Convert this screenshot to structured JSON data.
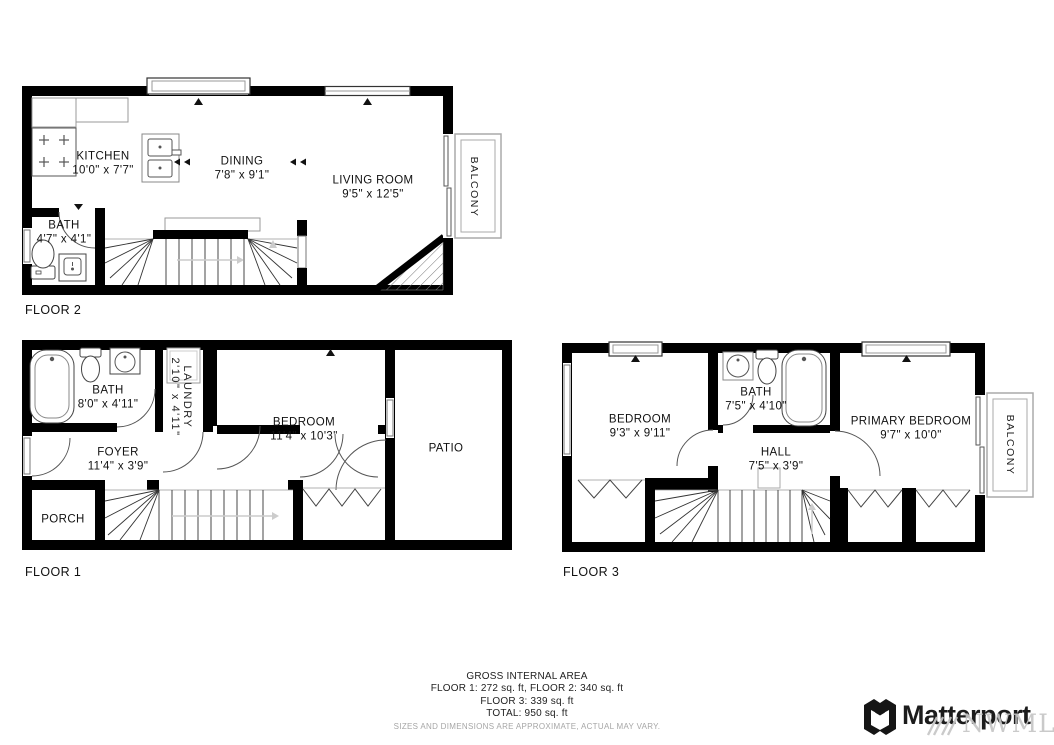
{
  "floors": {
    "floor2": {
      "label": "FLOOR 2",
      "rooms": {
        "kitchen": {
          "name": "KITCHEN",
          "dims": "10'0\" x 7'7\""
        },
        "dining": {
          "name": "DINING",
          "dims": "7'8\" x 9'1\""
        },
        "living_room": {
          "name": "LIVING ROOM",
          "dims": "9'5\" x 12'5\""
        },
        "bath": {
          "name": "BATH",
          "dims": "4'7\" x 4'1\""
        },
        "balcony": {
          "name": "BALCONY"
        }
      }
    },
    "floor1": {
      "label": "FLOOR 1",
      "rooms": {
        "bath": {
          "name": "BATH",
          "dims": "8'0\" x 4'11\""
        },
        "laundry": {
          "name": "LAUNDRY",
          "dims": "2'10\" x 4'11\""
        },
        "bedroom": {
          "name": "BEDROOM",
          "dims": "11'4\" x 10'3\""
        },
        "foyer": {
          "name": "FOYER",
          "dims": "11'4\" x 3'9\""
        },
        "porch": {
          "name": "PORCH"
        },
        "patio": {
          "name": "PATIO"
        }
      }
    },
    "floor3": {
      "label": "FLOOR 3",
      "rooms": {
        "bedroom": {
          "name": "BEDROOM",
          "dims": "9'3\" x 9'11\""
        },
        "bath": {
          "name": "BATH",
          "dims": "7'5\" x 4'10\""
        },
        "primary_bedroom": {
          "name": "PRIMARY BEDROOM",
          "dims": "9'7\" x 10'0\""
        },
        "hall": {
          "name": "HALL",
          "dims": "7'5\" x 3'9\""
        },
        "balcony": {
          "name": "BALCONY"
        }
      }
    }
  },
  "summary": {
    "title": "GROSS INTERNAL AREA",
    "line1": "FLOOR 1: 272 sq. ft, FLOOR 2: 340 sq. ft",
    "line2": "FLOOR 3: 339 sq. ft",
    "line3": "TOTAL: 950 sq. ft",
    "disclaimer": "SIZES AND DIMENSIONS ARE APPROXIMATE, ACTUAL MAY VARY."
  },
  "branding": {
    "logo_text": "Matterport",
    "watermark_text": "NWMLS"
  },
  "colors": {
    "wall": "#000000",
    "background": "#ffffff",
    "watermark": "#c6c6c6"
  }
}
